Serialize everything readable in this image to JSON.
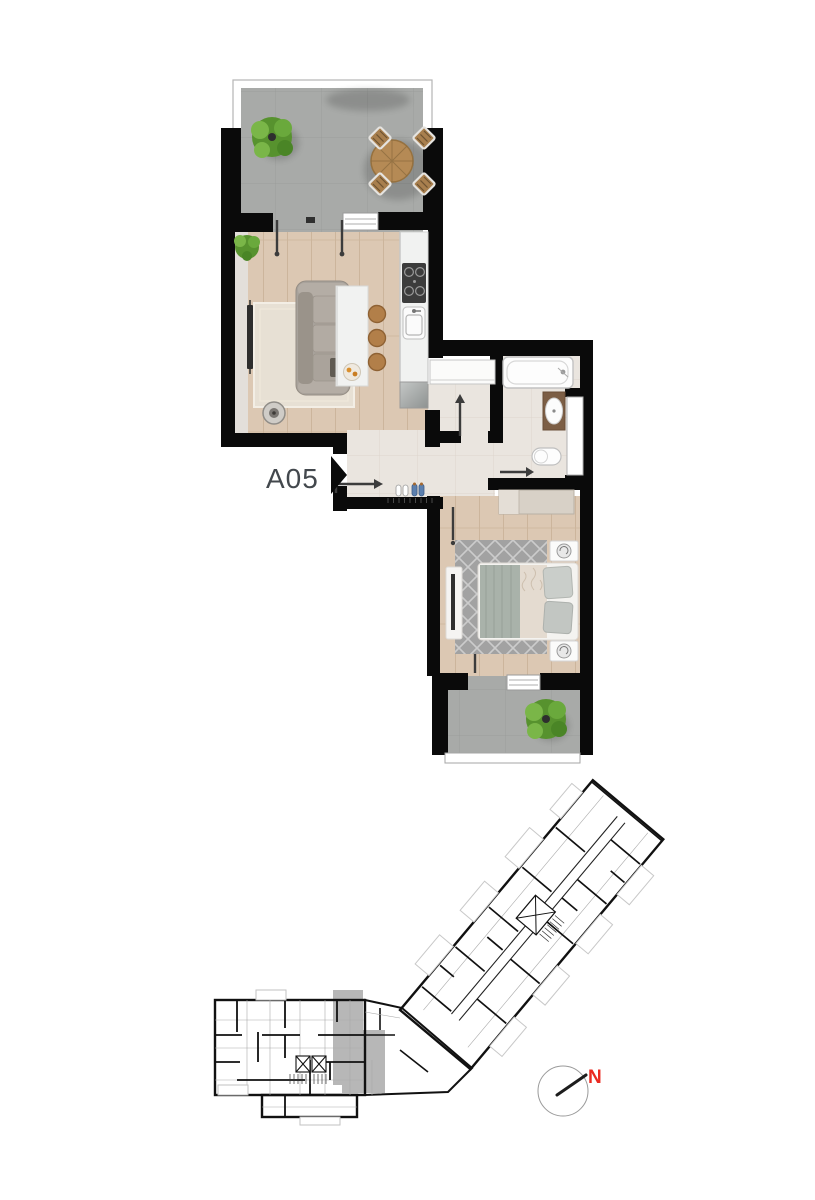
{
  "unit": {
    "label": "A05",
    "label_color": "#43484d",
    "marker": "entrance-arrow-right"
  },
  "compass": {
    "label": "N",
    "label_color": "#ea2a21"
  },
  "palette": {
    "wall": "#0a0a0a",
    "terrace_tile": "#a8aaa8",
    "terrace_tile_line": "#9b9d9b",
    "wood": "#dcc8b3",
    "wood_line": "#ccb59c",
    "hall_tile": "#eae5df",
    "hall_tile_line": "#ddd5cc",
    "rug_living": "#e7e0d4",
    "rug_bedroom": "#a2a2a2",
    "sofa": "#a8a29b",
    "island": "#f1f2f1",
    "stool": "#b27f49",
    "table": "#b58a55",
    "vanity": "#7c5e45",
    "wardrobe": "#d8d1c7",
    "plant_green": "#57922e",
    "highlight_unit": "#b7b7b7",
    "fixture_white": "#fdfdfd"
  },
  "apartment": {
    "rooms": [
      "terrace",
      "living-room-with-kitchen",
      "hall",
      "corridor",
      "bathroom",
      "bedroom",
      "balcony"
    ],
    "furniture": {
      "terrace": [
        "potted-plant",
        "round-dining-table",
        "four-garden-chairs"
      ],
      "living_room": [
        "potted-plant",
        "tv",
        "rug",
        "sofa",
        "floor-lamp",
        "kitchen-island",
        "three-bar-stools",
        "fruit-tray"
      ],
      "kitchen": [
        "counter",
        "gas-hob",
        "sink",
        "fridge"
      ],
      "hall": [
        "entry-door-swing",
        "slippers",
        "shoes",
        "coat-hooks"
      ],
      "corridor": [
        "built-in-closet",
        "door-swing"
      ],
      "bathroom": [
        "bathtub",
        "washbasin-vanity",
        "toilet",
        "door-swing"
      ],
      "bedroom": [
        "wardrobe",
        "double-bed",
        "two-nightstands",
        "rug",
        "tv-stand"
      ],
      "balcony": [
        "potted-plant",
        "railing"
      ]
    }
  },
  "overview": {
    "highlighted_unit": "A05",
    "wings": [
      "left-wing",
      "right-wing-rotated"
    ],
    "features": [
      "elevator-cores",
      "stairs",
      "balconies",
      "compass"
    ]
  }
}
